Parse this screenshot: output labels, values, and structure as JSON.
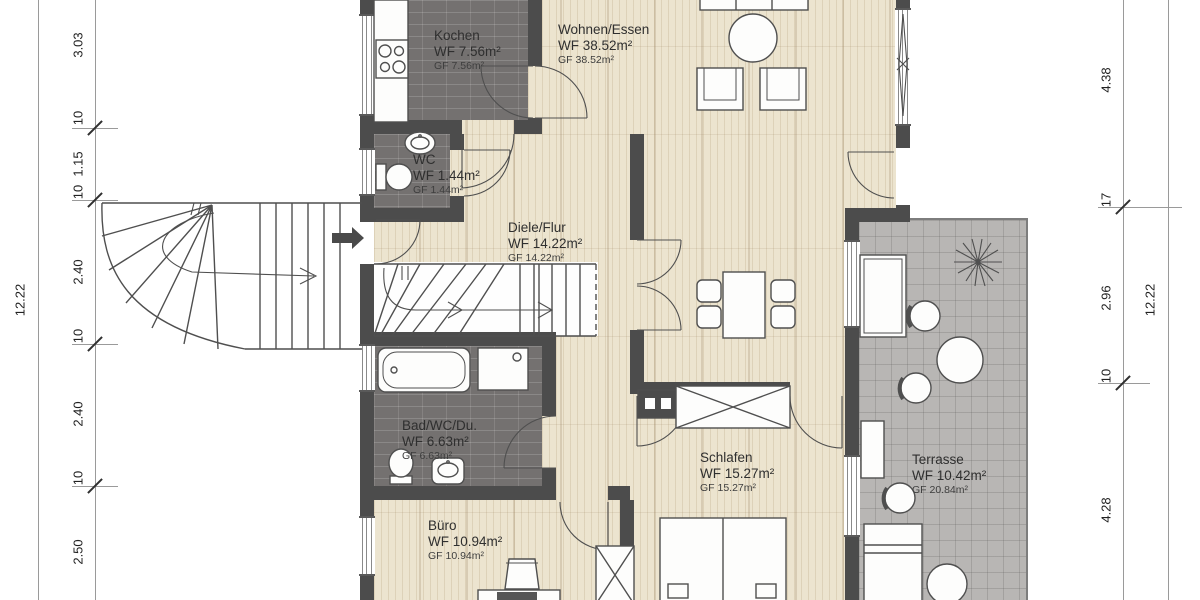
{
  "rooms": {
    "kochen": {
      "name": "Kochen",
      "wf": "WF 7.56m²",
      "gf": "GF 7.56m²"
    },
    "wohnen": {
      "name": "Wohnen/Essen",
      "wf": "WF 38.52m²",
      "gf": "GF 38.52m²"
    },
    "wc": {
      "name": "WC",
      "wf": "WF 1.44m²",
      "gf": "GF 1.44m²"
    },
    "diele": {
      "name": "Diele/Flur",
      "wf": "WF 14.22m²",
      "gf": "GF 14.22m²"
    },
    "bad": {
      "name": "Bad/WC/Du.",
      "wf": "WF 6.63m²",
      "gf": "GF 6.63m²"
    },
    "buero": {
      "name": "Büro",
      "wf": "WF 10.94m²",
      "gf": "GF 10.94m²"
    },
    "schlafen": {
      "name": "Schlafen",
      "wf": "WF 15.27m²",
      "gf": "GF 15.27m²"
    },
    "terrasse": {
      "name": "Terrasse",
      "wf": "WF 10.42m²",
      "gf": "GF 20.84m²"
    }
  },
  "dimensions": {
    "left_outer": "12.22",
    "left_chain": [
      "3.03",
      "10",
      "1.15",
      "10",
      "2.40",
      "10",
      "2.40",
      "10",
      "2.50"
    ],
    "right_chain": [
      "4.38",
      "17",
      "2.96",
      "10",
      "4.28"
    ],
    "right_outer": "12.22"
  },
  "colors": {
    "wall": "#4c4c4c",
    "tile_floor": "#747170",
    "wood_floor": "#ece4cf",
    "terrace_floor": "#b8b6b4"
  }
}
